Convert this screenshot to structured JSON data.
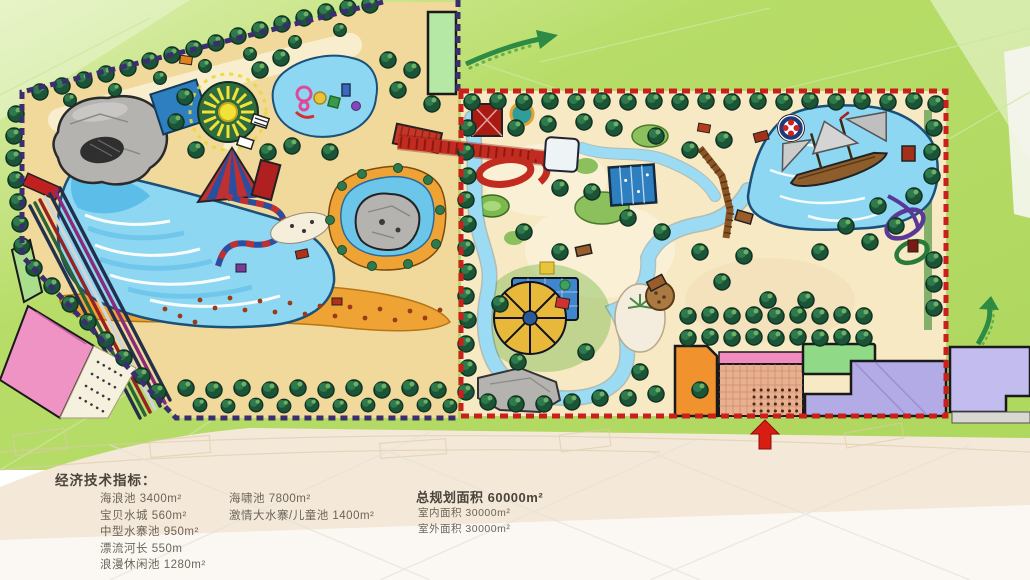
{
  "indicators": {
    "title": "经济技术指标：",
    "col1": [
      "海浪池 3400m²",
      "宝贝水城 560m²",
      "中型水寨池 950m²",
      "漂流河长 550m",
      "浪漫休闲池 1280m²"
    ],
    "col2": [
      "海啸池 7800m²",
      "激情大水寨/儿童池 1400m²"
    ],
    "col3_title": "总规划面积 60000m²",
    "col3": [
      "室内面积 30000m²",
      "室外面积 30000m²"
    ]
  },
  "palette": {
    "bg_green": "#b7dd68",
    "bg_green_light": "#ddefb0",
    "cream": "#f4e9d8",
    "cream_light": "#fbf8f3",
    "sand": "#f1d99b",
    "sand_light": "#f7e9c3",
    "beach": "#f0a335",
    "water": "#8ed7f2",
    "water_mid": "#54b9e6",
    "water_deep": "#2e7fc0",
    "river": "#9bdcf4",
    "tree_dark": "#1c5438",
    "tree_mid": "#2f7a4c",
    "tree_light": "#6cb065",
    "border_navy": "#3a2f6e",
    "border_red": "#c9201d",
    "rock": "#b5b3b0",
    "slide_red": "#c22b1f",
    "bld_pink": "#ef93c5",
    "bld_purple": "#b3abe5",
    "bld_green": "#8fd987",
    "bld_orange": "#f0922d",
    "bld_salmon": "#e9b08f",
    "bld_lightgreen": "#b5e8a4",
    "ship_brown": "#8e5d2c",
    "sail_grey": "#cccccc",
    "arrow_green": "#2e8b44",
    "arrow_red": "#d81d12",
    "text_title": "#4a443c",
    "text_body": "#6b645a"
  }
}
